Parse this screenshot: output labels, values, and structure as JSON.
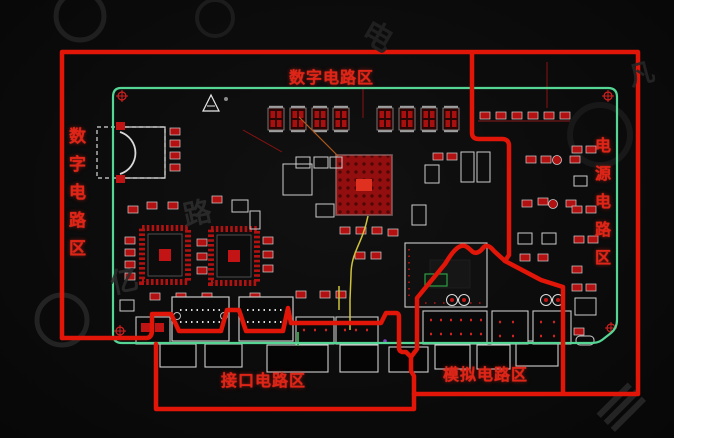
{
  "zones": {
    "digital_top_label": "数字电路区",
    "digital_left_label": "数字电路区",
    "power_label": "电源电路区",
    "interface_label": "接口电路区",
    "analog_label": "模拟电路区"
  },
  "watermark": {
    "chars": [
      "亿",
      "路",
      "电",
      "凡"
    ]
  },
  "colors": {
    "zone_border_red": "#e21608",
    "label_red": "#df2517",
    "board_outline_green": "#55d695",
    "pcb_background": "#0b0b0b",
    "letterbox_white": "#ffffff",
    "component_red": "#b31111",
    "component_dark_red": "#7a0f0f",
    "silkscreen_white": "#cfcfcf",
    "trace_yellow": "#cfc23a"
  }
}
